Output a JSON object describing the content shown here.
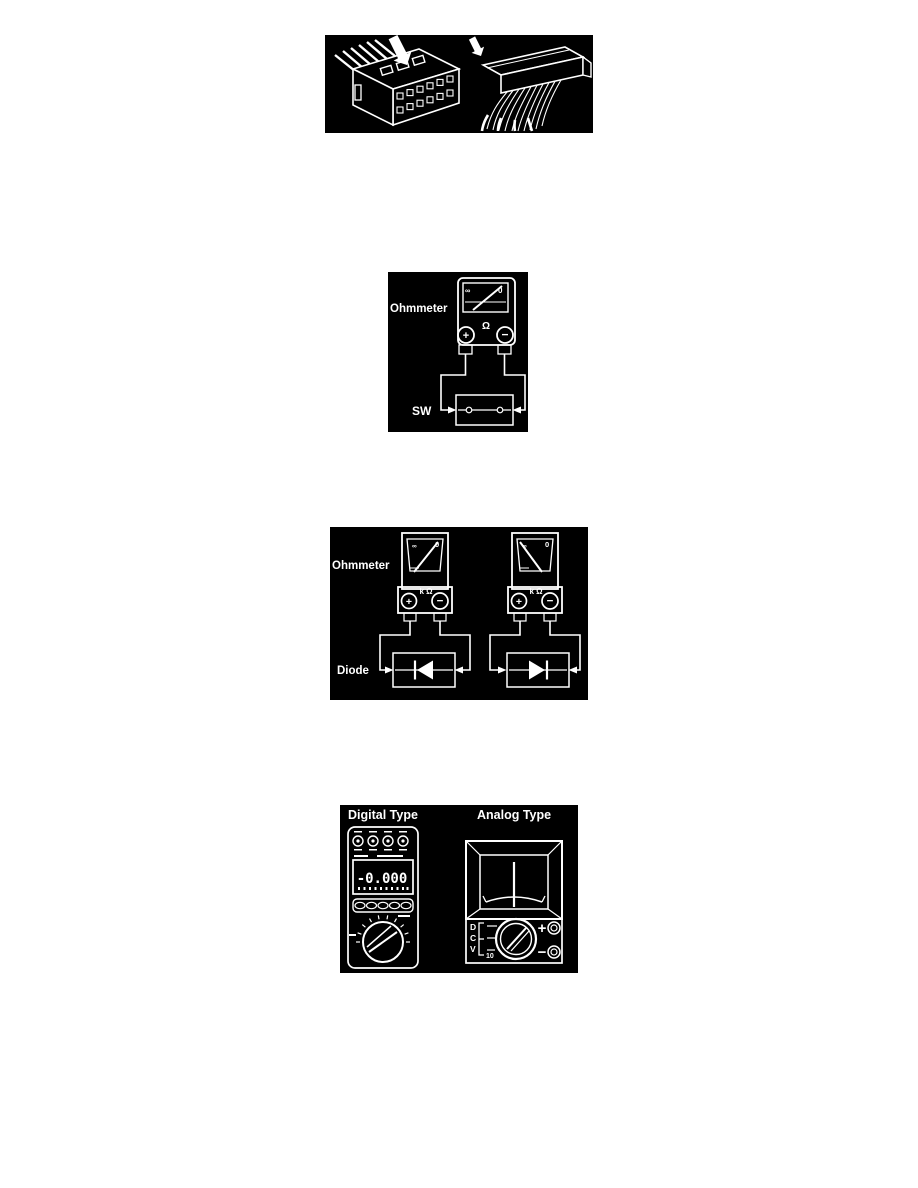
{
  "figures": {
    "switch_test": {
      "label_ohmmeter": "Ohmmeter",
      "label_sw": "SW",
      "scale_infinity": "∞",
      "scale_zero": "0",
      "unit_omega": "Ω",
      "terminal_plus": "+",
      "terminal_minus": "−"
    },
    "diode_test": {
      "label_ohmmeter": "Ohmmeter",
      "label_diode": "Diode",
      "scale_infinity": "∞",
      "scale_zero": "0",
      "unit_kilohm": "k Ω",
      "terminal_plus": "+",
      "terminal_minus": "−"
    },
    "meter_types": {
      "label_digital": "Digital Type",
      "label_analog": "Analog Type",
      "digital_reading": "-0.000",
      "analog_letter_d": "D",
      "analog_letter_c": "C",
      "analog_letter_v": "V",
      "analog_range_10": "10",
      "terminal_plus": "+",
      "terminal_minus": "−"
    }
  }
}
